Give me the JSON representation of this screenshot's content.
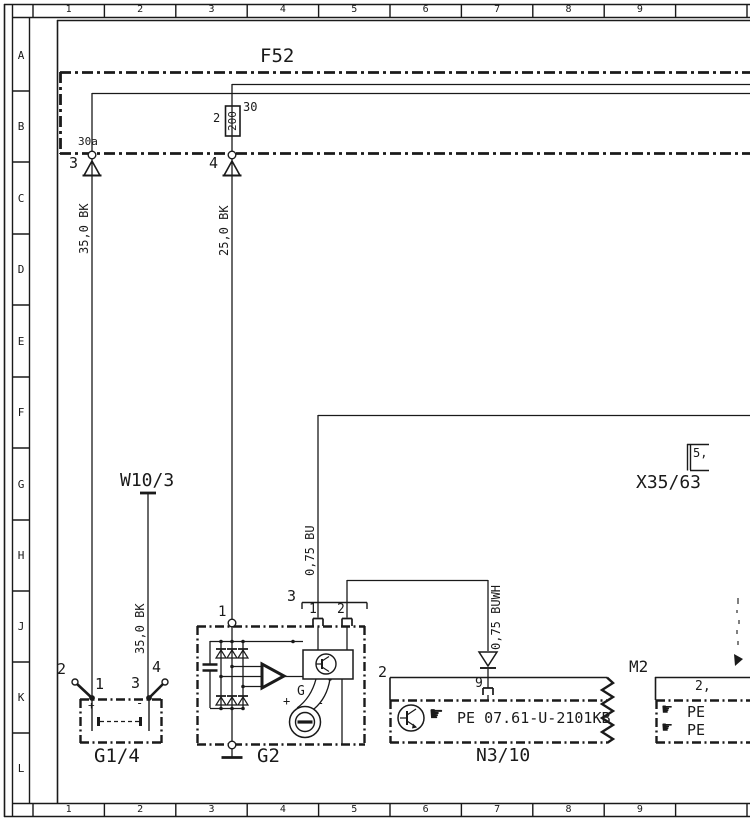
{
  "window": {
    "background": "#ffffff",
    "ink": "#1a1a1a"
  },
  "grid": {
    "columns": [
      "1",
      "2",
      "3",
      "4",
      "5",
      "6",
      "7",
      "8",
      "9"
    ],
    "rows": [
      "A",
      "B",
      "C",
      "D",
      "E",
      "F",
      "G",
      "H",
      "J",
      "K",
      "L"
    ]
  },
  "fuse_circuit": {
    "component_label": "F52",
    "fuse_rating": "200",
    "fuse_pin": "2",
    "fuse_terminal": "30",
    "terminal": "30a",
    "plug_left": "3",
    "plug_right": "4"
  },
  "wire_labels": {
    "left_feed": "35,0 BK",
    "mid_feed": "25,0 BK",
    "ground_wire": "35,0 BK",
    "bu_wire": "0,75 BU",
    "buwh_wire": "0,75 BUWH"
  },
  "ground_point": {
    "label": "W10/3"
  },
  "connector": {
    "label": "X35/63",
    "detail": "5,"
  },
  "battery": {
    "label": "G1/4",
    "pin1": "1",
    "pin2": "2",
    "pin3": "3",
    "pin4": "4",
    "plus": "+",
    "minus": "-"
  },
  "alternator": {
    "label": "G2",
    "top_pin": "1",
    "connector_label": "3",
    "pin1": "1",
    "pin2": "2",
    "generator": "G",
    "plus": "+",
    "minus": "-"
  },
  "control_unit": {
    "label": "N3/10",
    "pin_left": "2",
    "pin9": "9",
    "hand_icon": "☛",
    "doc_ref": "PE 07.61-U-2101KB"
  },
  "motor": {
    "label": "M2",
    "pin": "2,",
    "hand_icon": "☛",
    "row1_label": "PE",
    "row2_label": "PE"
  }
}
